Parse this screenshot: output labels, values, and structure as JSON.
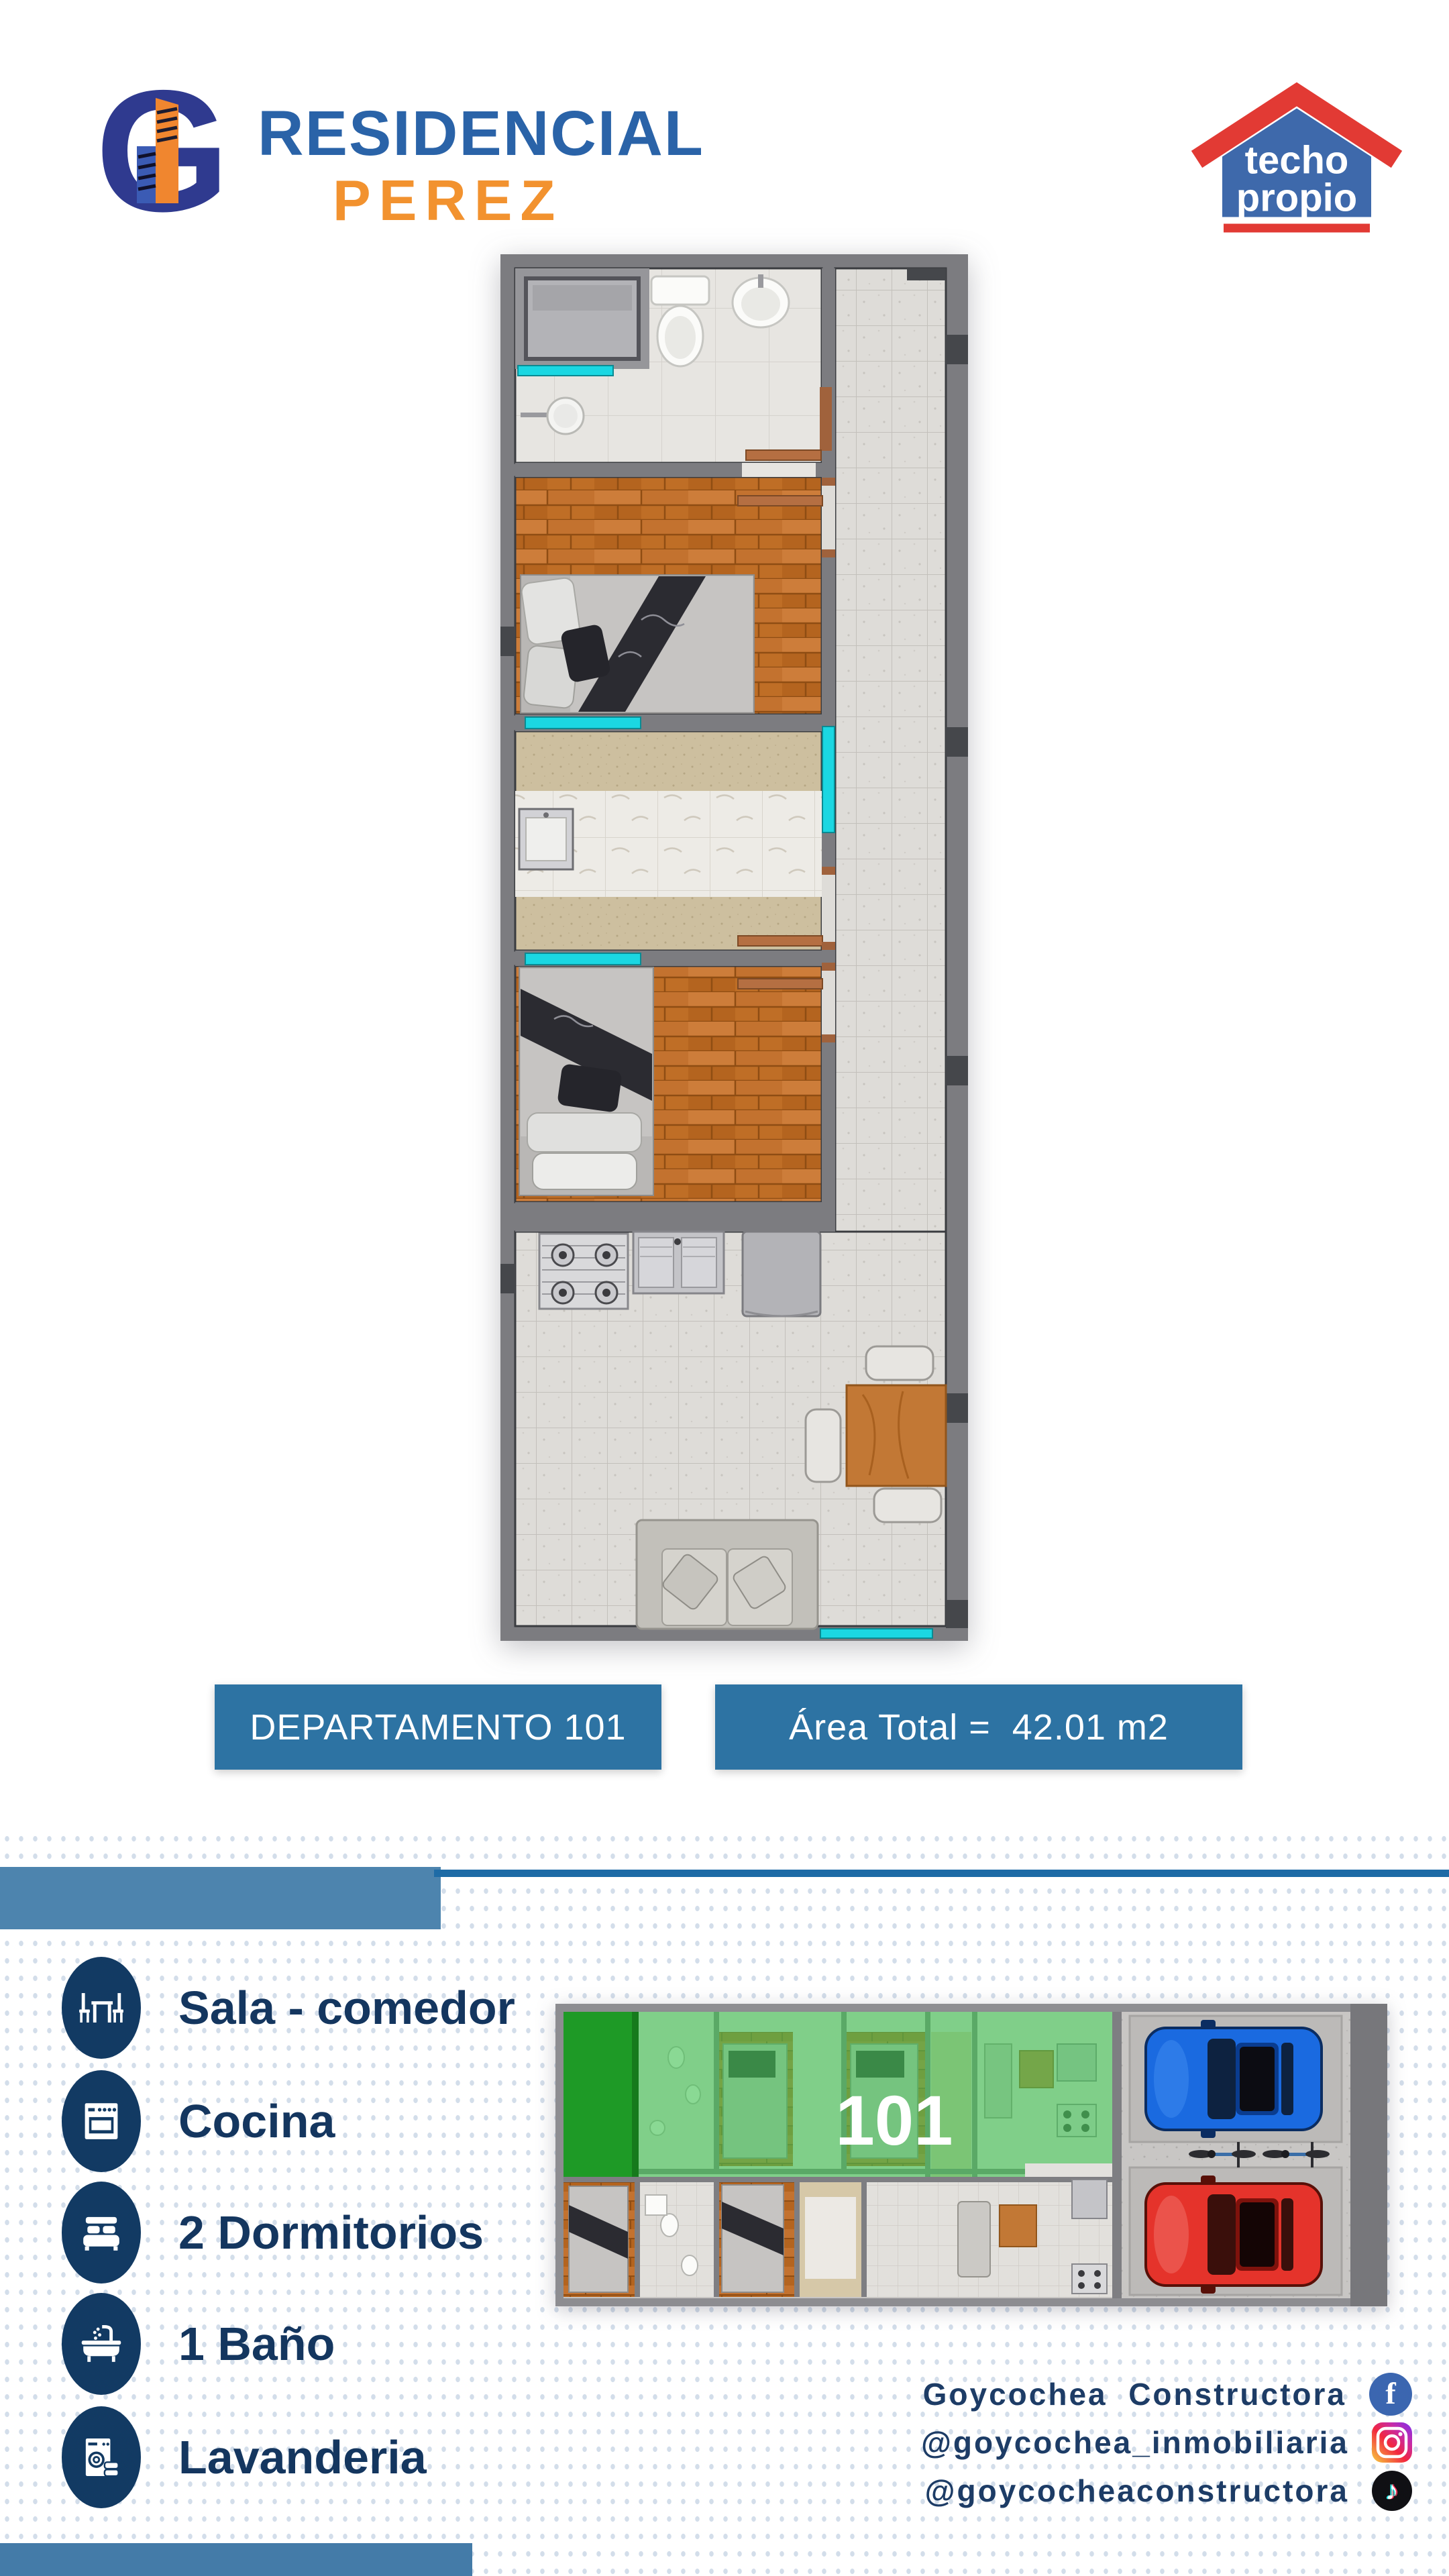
{
  "brand": {
    "title_line1": "RESIDENCIAL",
    "title_line2": "PEREZ",
    "logo_icon": "building-g-monogram-icon"
  },
  "techo_propio_badge": {
    "word1": "techo",
    "word2": "propio",
    "icon": "house-roof-icon"
  },
  "plan_labels": {
    "unit_button": "DEPARTAMENTO 101",
    "area_button": "Área Total =  42.01 m2"
  },
  "amenities": [
    {
      "icon": "dining-table-icon",
      "label": "Sala - comedor"
    },
    {
      "icon": "stove-icon",
      "label": "Cocina"
    },
    {
      "icon": "bed-icon",
      "label": "2 Dormitorios"
    },
    {
      "icon": "bathtub-icon",
      "label": "1 Baño"
    },
    {
      "icon": "washing-machine-icon",
      "label": "Lavanderia"
    }
  ],
  "site_plan": {
    "unit_label": "101"
  },
  "social": [
    {
      "icon": "facebook-icon",
      "label": "Goycochea  Constructora"
    },
    {
      "icon": "instagram-icon",
      "label": "@goycochea_inmobiliaria"
    },
    {
      "icon": "tiktok-icon",
      "label": "@goycocheaconstructora"
    }
  ],
  "colors": {
    "button_blue": "#2d73a3",
    "band_light_blue": "#4d84ae",
    "band_dark_blue": "#1e6ba6",
    "bottom_bar_blue": "#447ba8",
    "navy": "#123a63",
    "brand_blue": "#2a63a8",
    "brand_orange": "#f2922f",
    "window_cyan": "#1bd7e2",
    "unit_highlight_green": "#44c455"
  }
}
